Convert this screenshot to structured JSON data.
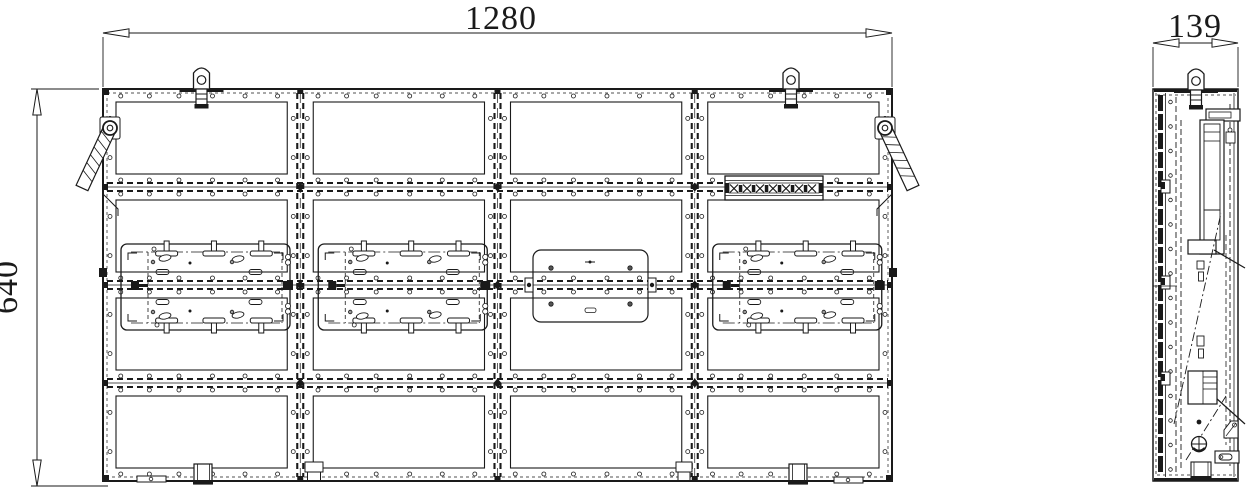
{
  "dimensions": {
    "front_width": "1280",
    "front_height": "640",
    "side_depth": "139"
  },
  "colors": {
    "line": "#1a1a1a",
    "background": "#ffffff"
  }
}
